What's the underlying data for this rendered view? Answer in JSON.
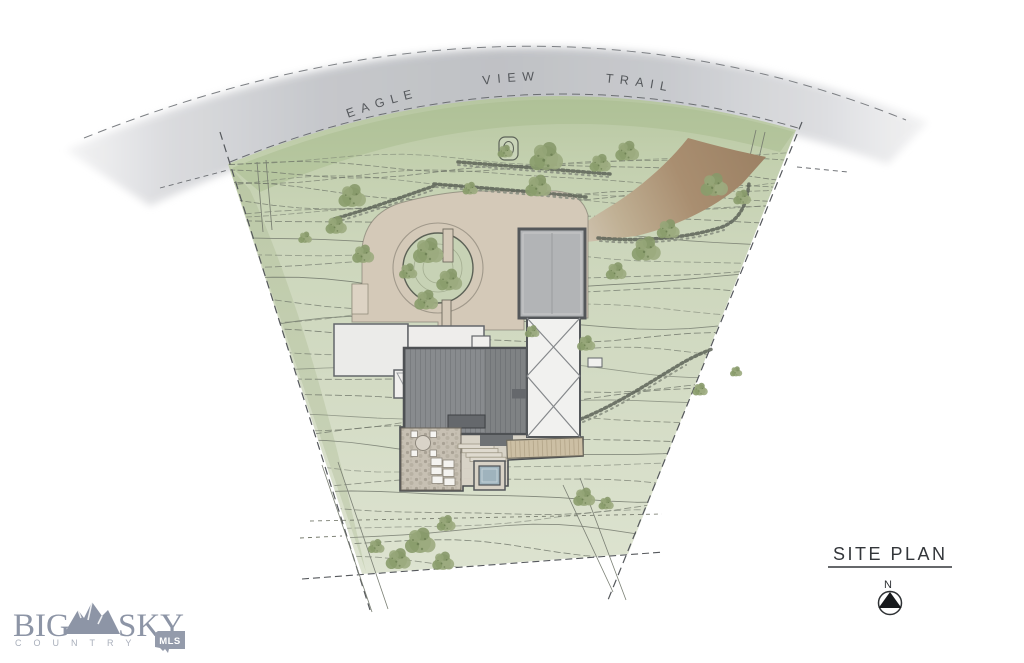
{
  "document": {
    "type_label": "residential site plan rendering"
  },
  "road": {
    "name": "EAGLE VIEW TRAIL"
  },
  "title_block": {
    "title": "SITE PLAN",
    "north_indicator": "N"
  },
  "brand": {
    "word_left": "BIG",
    "word_right": "SKY",
    "tagline": "COUNTRY",
    "badge": "MLS",
    "color": "#8d95a6",
    "tagline_color": "#a9afbb",
    "badge_text_color": "#ffffff"
  },
  "palette": {
    "paper": "#ffffff",
    "road": "#c3c5c9",
    "terrain": "#cfd8bf",
    "terrain_dark": "#a7bb8e",
    "driveway": "#d4c9b8",
    "dirt_drive": "#a78c6d",
    "roof_dark": "#888b8e",
    "roof_trim": "#4e5154",
    "roof_light": "#b2b4b6",
    "deck_wood": "#ccbfa4",
    "water": "#9fb3bd",
    "tree": "#93a476",
    "contour": "#70766a",
    "boundary": "#55585c"
  },
  "site": {
    "features": [
      {
        "name": "road",
        "label": "EAGLE VIEW TRAIL"
      },
      {
        "name": "property-boundary",
        "style": "dashed"
      },
      {
        "name": "topographic-contours"
      },
      {
        "name": "gravel-driveway"
      },
      {
        "name": "dirt-drive-entry"
      },
      {
        "name": "motor-court-island"
      },
      {
        "name": "garage-roof"
      },
      {
        "name": "main-residence-roof"
      },
      {
        "name": "crossed-deck"
      },
      {
        "name": "stone-patio"
      },
      {
        "name": "hot-tub"
      },
      {
        "name": "wood-deck"
      },
      {
        "name": "rock-walls"
      },
      {
        "name": "trees"
      }
    ],
    "trees": [
      {
        "x": 352,
        "y": 197,
        "s": 0.9
      },
      {
        "x": 336,
        "y": 226,
        "s": 0.7
      },
      {
        "x": 363,
        "y": 255,
        "s": 0.72
      },
      {
        "x": 428,
        "y": 252,
        "s": 1.0
      },
      {
        "x": 449,
        "y": 281,
        "s": 0.85
      },
      {
        "x": 426,
        "y": 301,
        "s": 0.78
      },
      {
        "x": 408,
        "y": 272,
        "s": 0.6
      },
      {
        "x": 505,
        "y": 152,
        "s": 0.5
      },
      {
        "x": 546,
        "y": 158,
        "s": 1.1
      },
      {
        "x": 538,
        "y": 187,
        "s": 0.85
      },
      {
        "x": 600,
        "y": 164,
        "s": 0.7
      },
      {
        "x": 627,
        "y": 152,
        "s": 0.78
      },
      {
        "x": 714,
        "y": 186,
        "s": 0.9
      },
      {
        "x": 742,
        "y": 198,
        "s": 0.58
      },
      {
        "x": 646,
        "y": 250,
        "s": 0.95
      },
      {
        "x": 668,
        "y": 230,
        "s": 0.75
      },
      {
        "x": 616,
        "y": 272,
        "s": 0.68
      },
      {
        "x": 586,
        "y": 344,
        "s": 0.6
      },
      {
        "x": 532,
        "y": 332,
        "s": 0.48
      },
      {
        "x": 700,
        "y": 390,
        "s": 0.5
      },
      {
        "x": 736,
        "y": 372,
        "s": 0.4
      },
      {
        "x": 420,
        "y": 542,
        "s": 1.0
      },
      {
        "x": 398,
        "y": 560,
        "s": 0.82
      },
      {
        "x": 443,
        "y": 562,
        "s": 0.72
      },
      {
        "x": 446,
        "y": 524,
        "s": 0.62
      },
      {
        "x": 376,
        "y": 547,
        "s": 0.55
      },
      {
        "x": 584,
        "y": 498,
        "s": 0.72
      },
      {
        "x": 606,
        "y": 504,
        "s": 0.5
      },
      {
        "x": 470,
        "y": 189,
        "s": 0.5
      },
      {
        "x": 305,
        "y": 238,
        "s": 0.45
      }
    ]
  }
}
